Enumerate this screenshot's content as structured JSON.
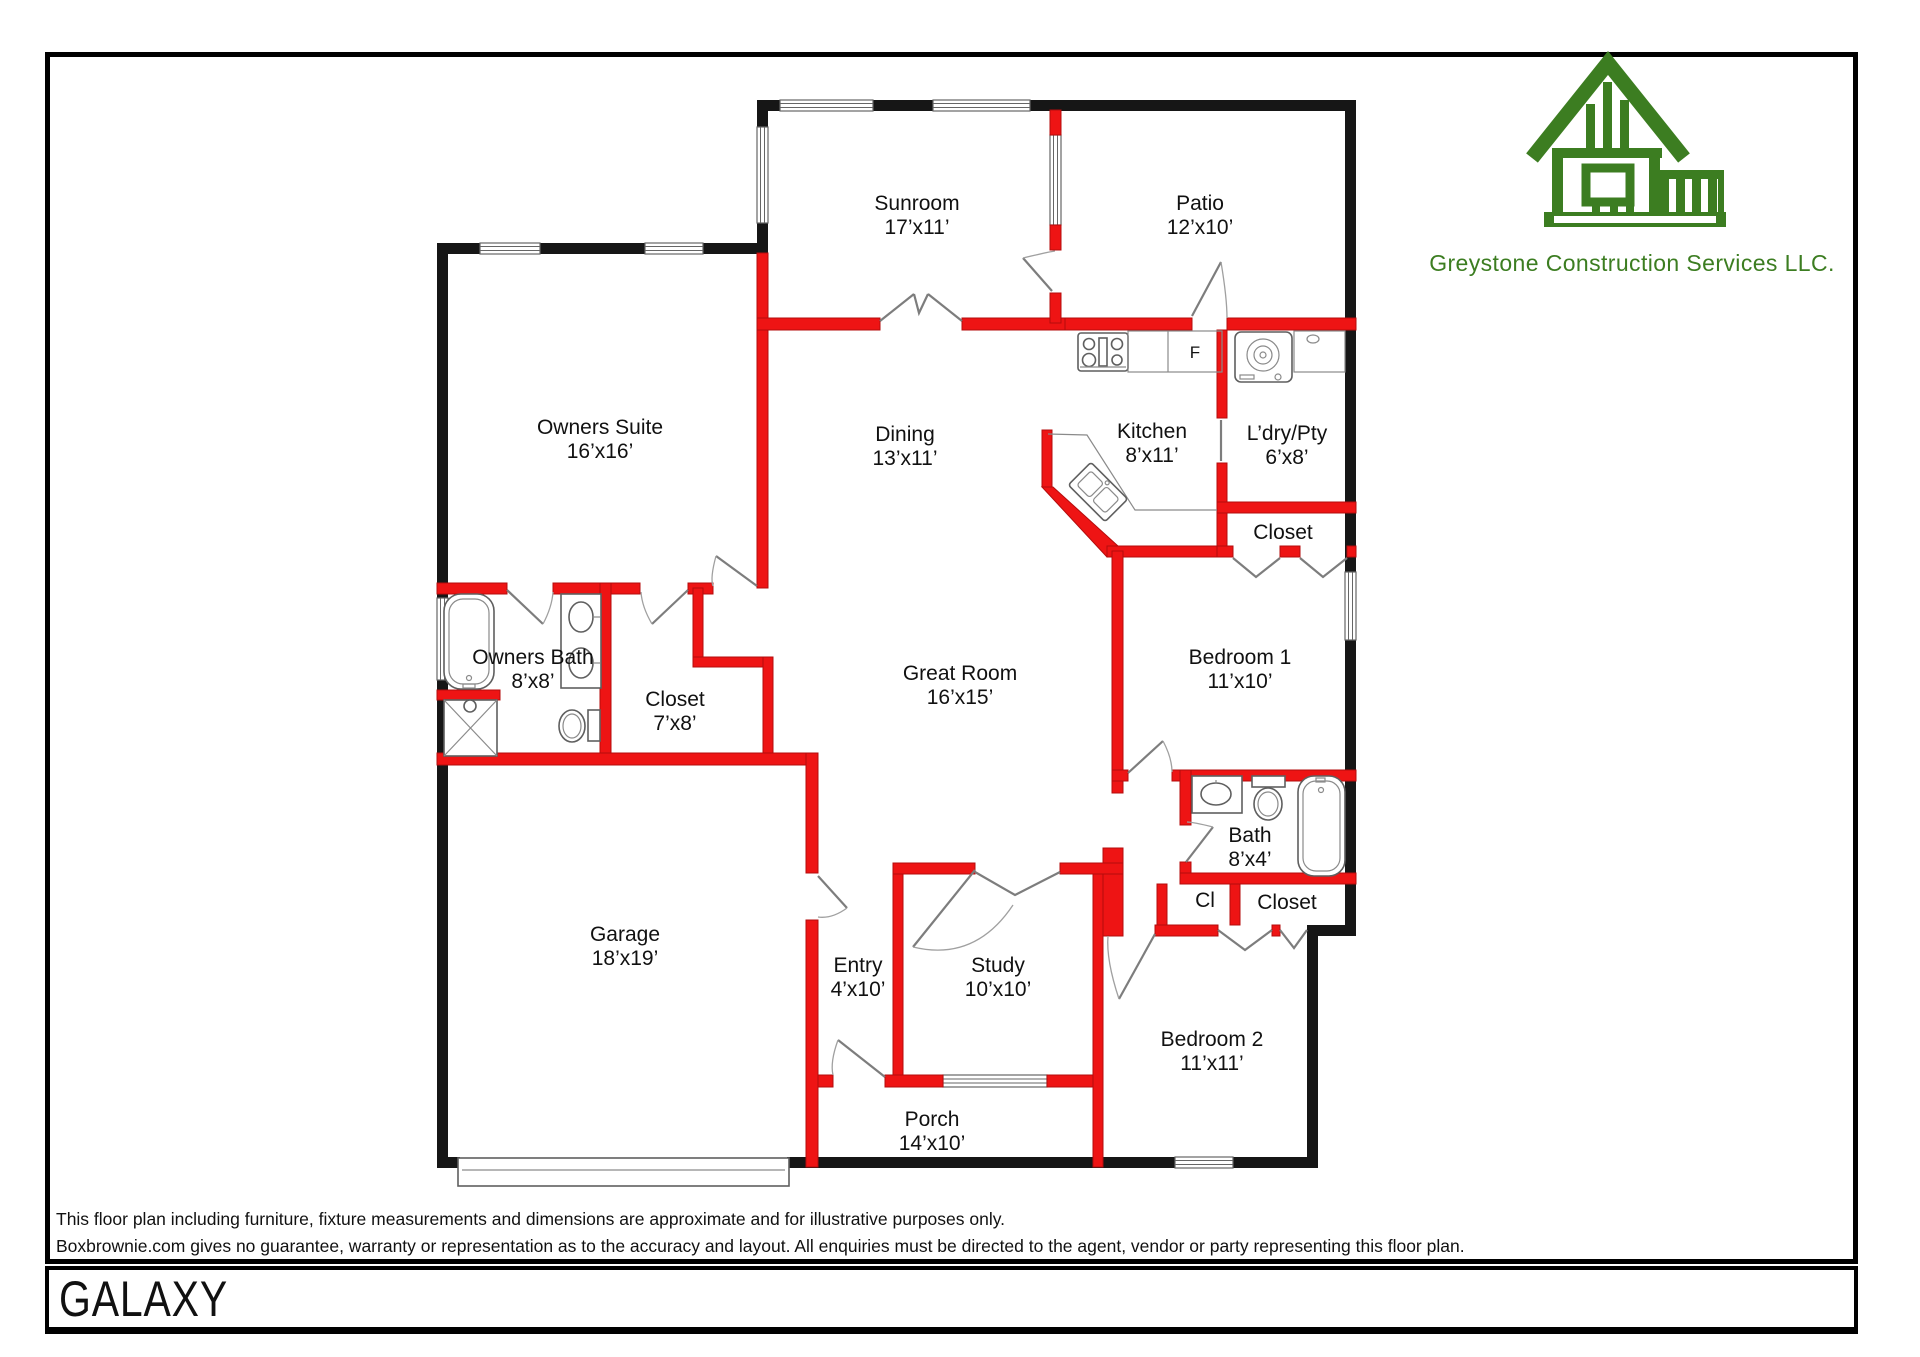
{
  "plan_title": "GALAXY",
  "branding": {
    "company_name": "Greystone Construction Services LLC.",
    "logo_color": "#3c7d21"
  },
  "disclaimer": {
    "line1": "This floor plan including furniture, fixture measurements and dimensions are approximate and for illustrative purposes only.",
    "line2": "Boxbrownie.com gives no guarantee, warranty or representation as to the accuracy and layout. All enquiries must be directed to the agent, vendor or party representing this floor plan."
  },
  "labels": {
    "fridge": "F"
  },
  "colors": {
    "exterior_wall": "#161616",
    "interior_wall": "#ee1414",
    "door_symbol": "#7d7d7d",
    "label_text": "#111111",
    "logo_green": "#3c7d21"
  },
  "icons": {
    "stove-icon": "svg-shape",
    "refrigerator-label": "text-F",
    "washer-icon": "svg-shape",
    "kitchen-sink-icon": "svg-shape",
    "bathtub-icon": "svg-shape",
    "shower-icon": "svg-shape",
    "vanity-sink-icon": "svg-shape",
    "toilet-icon": "svg-shape",
    "garage-door-icon": "svg-shape",
    "company-logo-icon": "svg-shape"
  },
  "rooms": [
    {
      "name": "Sunroom",
      "dims": "17’x11’",
      "x": 917,
      "y": 216
    },
    {
      "name": "Patio",
      "dims": "12’x10’",
      "x": 1200,
      "y": 216
    },
    {
      "name": "Owners Suite",
      "dims": "16’x16’",
      "x": 600,
      "y": 440
    },
    {
      "name": "Dining",
      "dims": "13’x11’",
      "x": 905,
      "y": 447
    },
    {
      "name": "Kitchen",
      "dims": "8’x11’",
      "x": 1152,
      "y": 444
    },
    {
      "name": "L’dry/Pty",
      "dims": "6’x8’",
      "x": 1287,
      "y": 446
    },
    {
      "name": "Closet",
      "dims": "",
      "x": 1283,
      "y": 533
    },
    {
      "name": "Owners Bath",
      "dims": "8’x8’",
      "x": 533,
      "y": 670
    },
    {
      "name": "Closet",
      "dims": "7’x8’",
      "x": 675,
      "y": 712
    },
    {
      "name": "Great Room",
      "dims": "16’x15’",
      "x": 960,
      "y": 686
    },
    {
      "name": "Bedroom 1",
      "dims": "11’x10’",
      "x": 1240,
      "y": 670
    },
    {
      "name": "Bath",
      "dims": "8’x4’",
      "x": 1250,
      "y": 848
    },
    {
      "name": "Cl",
      "dims": "",
      "x": 1205,
      "y": 901
    },
    {
      "name": "Closet",
      "dims": "",
      "x": 1287,
      "y": 903
    },
    {
      "name": "Garage",
      "dims": "18’x19’",
      "x": 625,
      "y": 947
    },
    {
      "name": "Entry",
      "dims": "4’x10’",
      "x": 858,
      "y": 978
    },
    {
      "name": "Study",
      "dims": "10’x10’",
      "x": 998,
      "y": 978
    },
    {
      "name": "Bedroom 2",
      "dims": "11’x11’",
      "x": 1212,
      "y": 1052
    },
    {
      "name": "Porch",
      "dims": "14’x10’",
      "x": 932,
      "y": 1132
    }
  ]
}
